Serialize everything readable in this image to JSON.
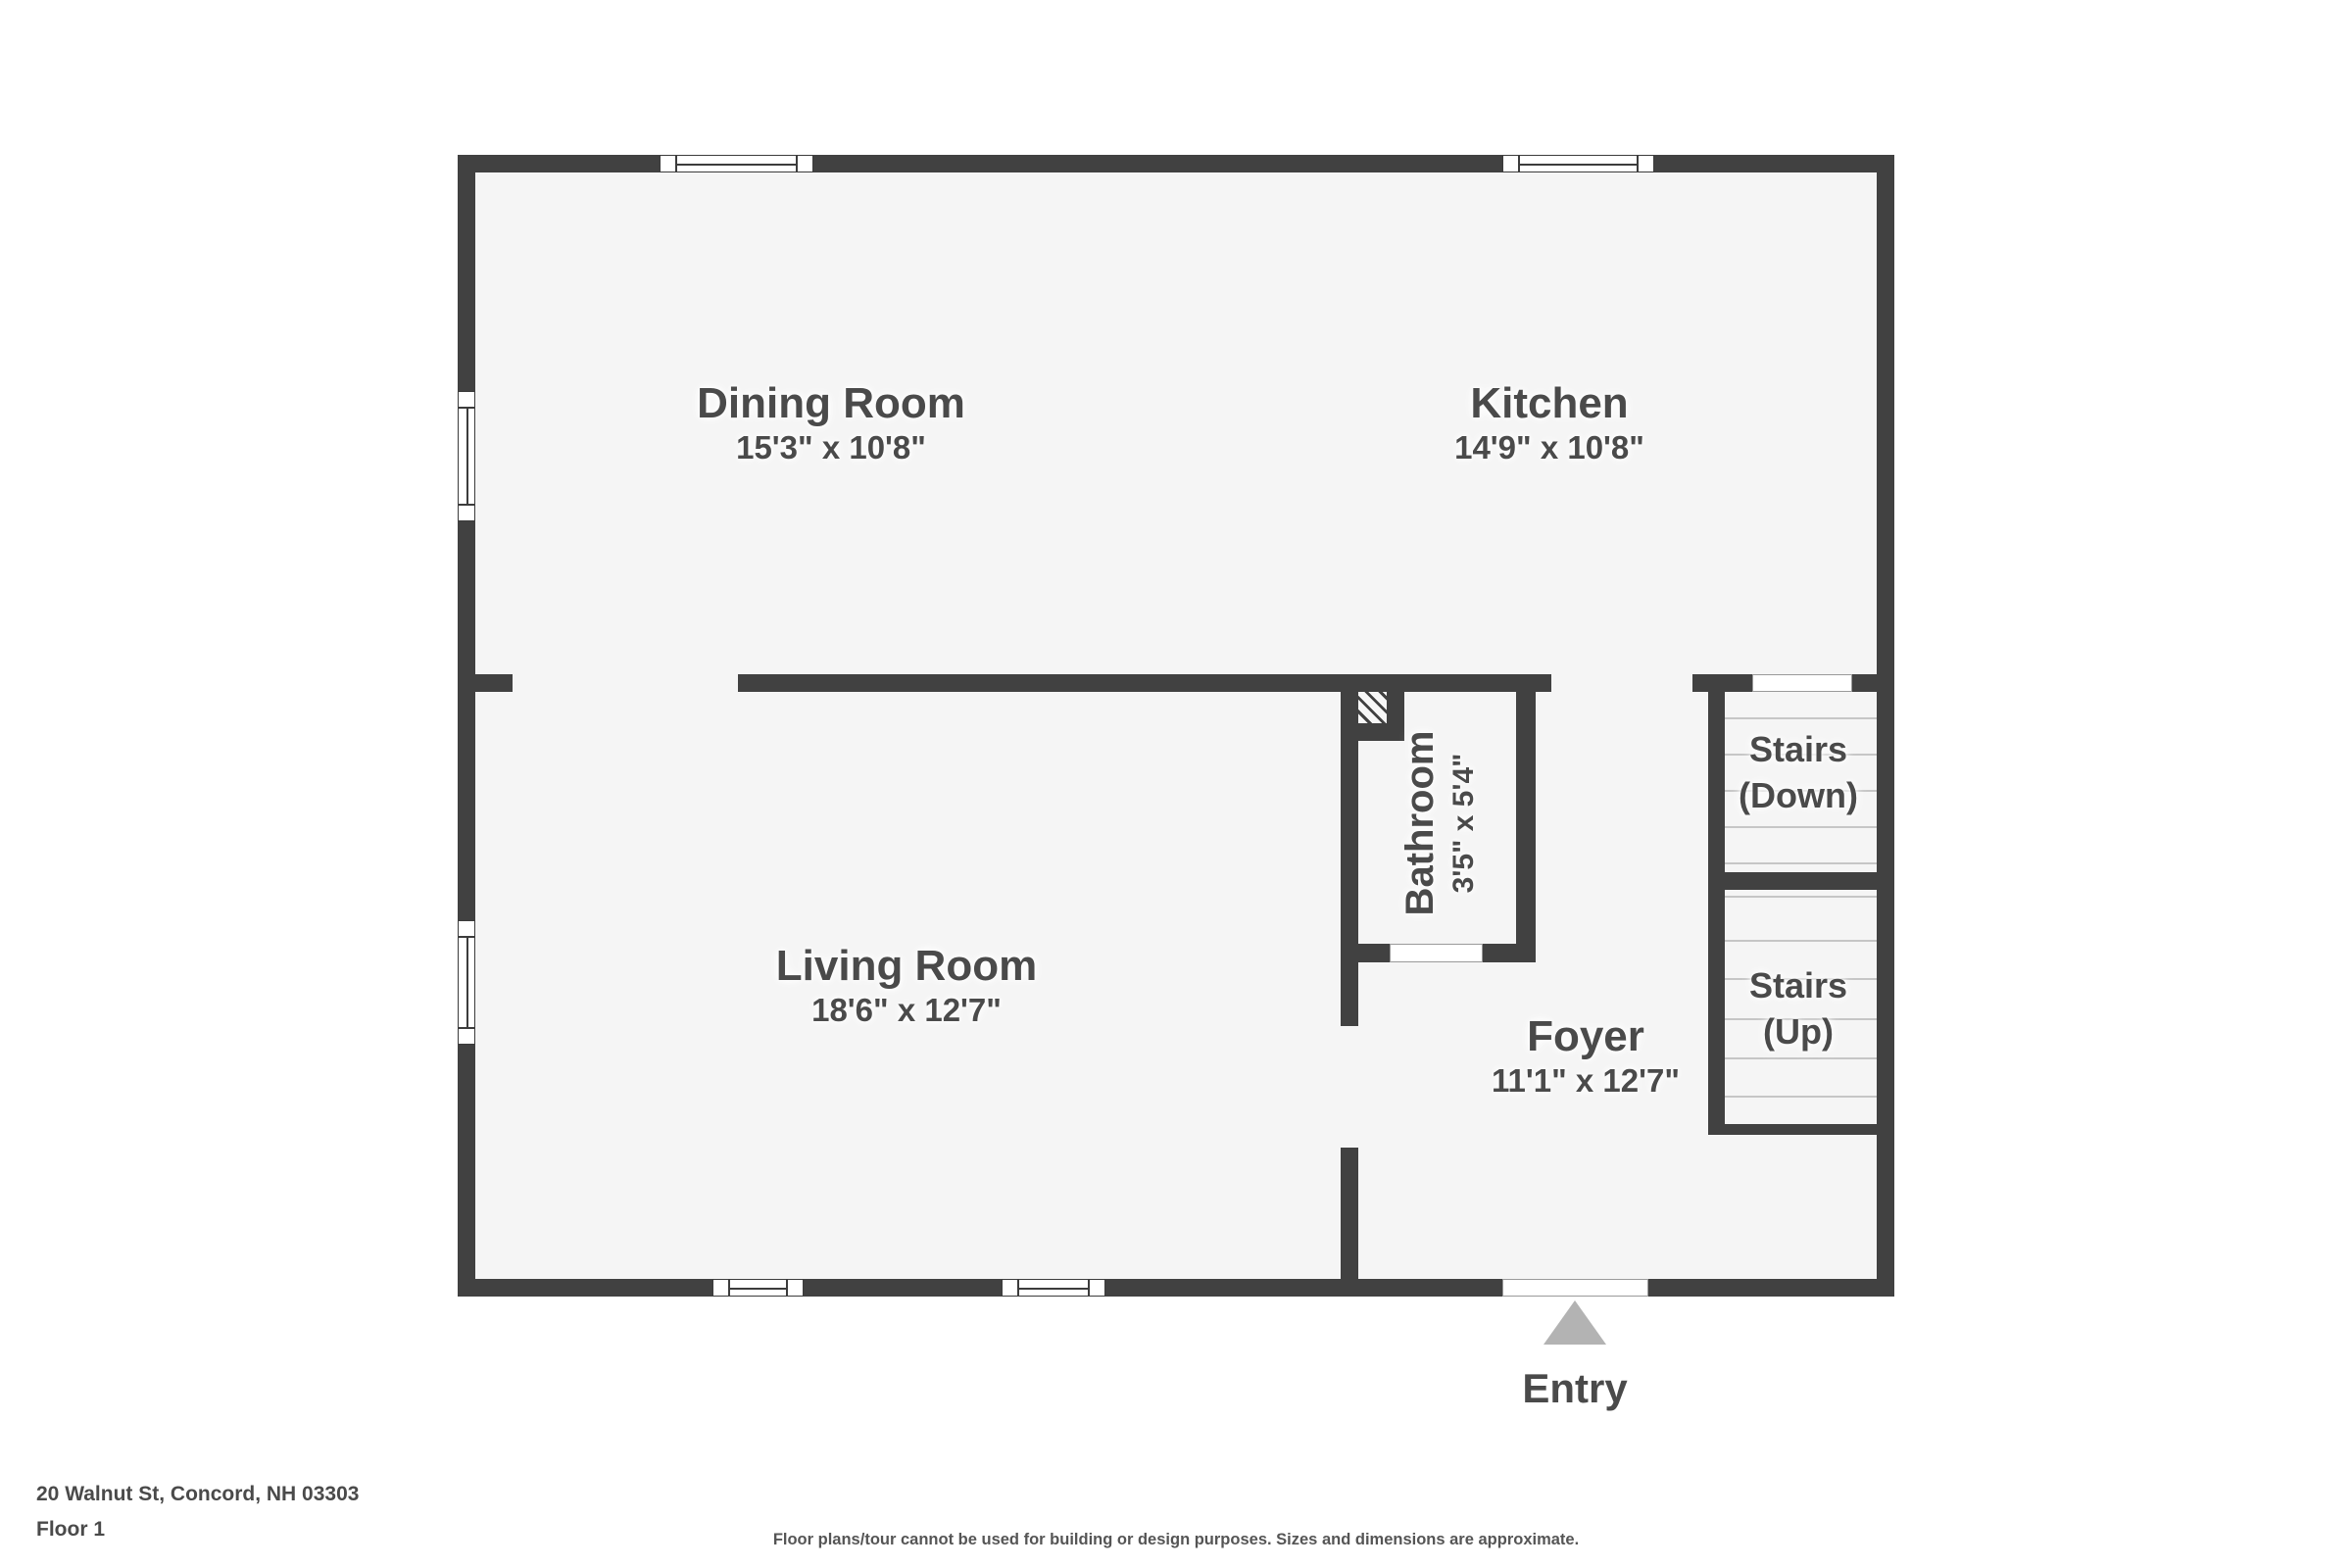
{
  "meta": {
    "address": "20 Walnut St, Concord, NH 03303",
    "floor_label": "Floor 1",
    "disclaimer": "Floor plans/tour cannot be used for building or design purposes. Sizes and dimensions are approximate."
  },
  "colors": {
    "wall": "#414141",
    "floor": "#f5f5f5",
    "background": "#ffffff",
    "label_text": "#4a4a4a",
    "stair_tread": "#c6c6c6",
    "entry_arrow": "#b3b3b3"
  },
  "rooms": [
    {
      "id": "dining-room",
      "name": "Dining Room",
      "dimensions": "15'3\" x 10'8\""
    },
    {
      "id": "kitchen",
      "name": "Kitchen",
      "dimensions": "14'9\" x 10'8\""
    },
    {
      "id": "living-room",
      "name": "Living Room",
      "dimensions": "18'6\" x 12'7\""
    },
    {
      "id": "bathroom",
      "name": "Bathroom",
      "dimensions": "3'5\" x 5'4\""
    },
    {
      "id": "foyer",
      "name": "Foyer",
      "dimensions": "11'1\" x 12'7\""
    }
  ],
  "stairs": [
    {
      "id": "stairs-down",
      "line1": "Stairs",
      "line2": "(Down)"
    },
    {
      "id": "stairs-up",
      "line1": "Stairs",
      "line2": "(Up)"
    }
  ],
  "entry": {
    "label": "Entry"
  }
}
